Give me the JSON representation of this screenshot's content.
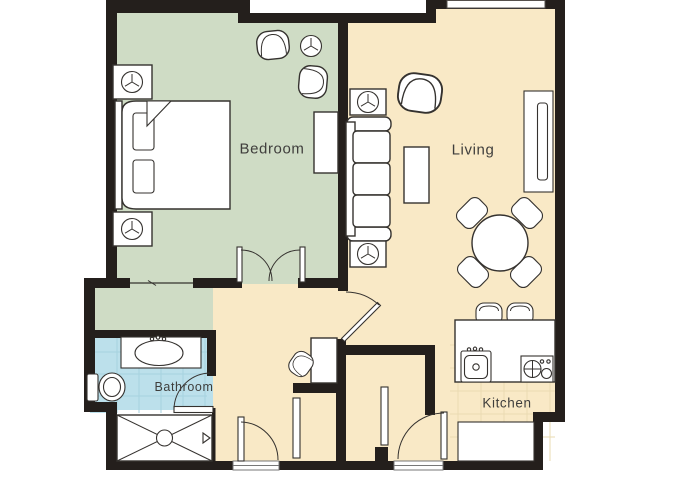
{
  "floorplan": {
    "rooms": [
      {
        "id": "bedroom",
        "label": "Bedroom",
        "color": "#cfdcc5"
      },
      {
        "id": "living",
        "label": "Living",
        "color": "#f9e9c6"
      },
      {
        "id": "bathroom",
        "label": "Bathroom",
        "color": "#bce0eb"
      },
      {
        "id": "kitchen",
        "label": "Kitchen",
        "color": "#f9e9c6"
      }
    ],
    "colors": {
      "background": "#ffffff",
      "wall": "#241f1c",
      "closet": "#cfdcc5",
      "hallway": "#f9e9c6",
      "furniture_fill": "#ffffff",
      "furniture_outline": "#35322f",
      "label_text": "#3f3e3c",
      "bathroom_tile_line": "#a6d2df",
      "kitchen_tile_line": "#eadbb2"
    },
    "icons": [
      "bed-icon",
      "pillow-icon",
      "blanket-fold-icon",
      "nightstand-lamp-icon",
      "floor-lamp-icon",
      "armchair-icon",
      "dresser-icon",
      "closet-slider-icon",
      "french-doors-icon",
      "door-swing-icon",
      "sofa-icon",
      "end-table-lamp-icon",
      "coffee-table-icon",
      "tv-console-icon",
      "window-icon",
      "dining-table-icon",
      "dining-chair-icon",
      "bar-stool-icon",
      "kitchen-counter-icon",
      "kitchen-sink-icon",
      "stove-icon",
      "vanity-sink-icon",
      "toilet-icon",
      "shower-icon",
      "desk-icon",
      "desk-chair-icon"
    ]
  }
}
